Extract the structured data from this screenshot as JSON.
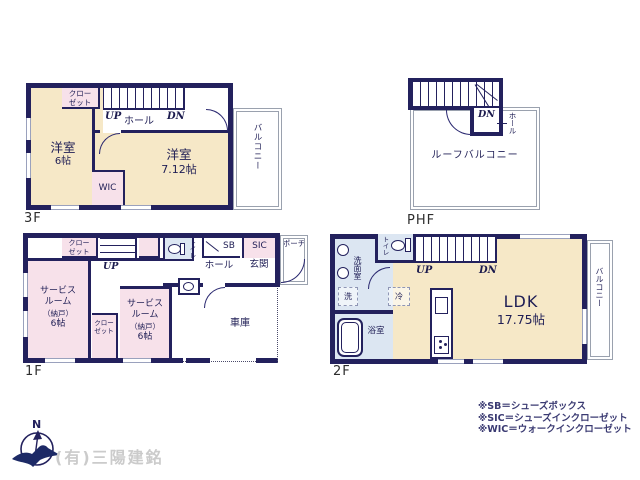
{
  "colors": {
    "wall_navy": "#23215d",
    "room_cream": "#f6e8c7",
    "room_pink": "#f7e1ea",
    "room_blue": "#dce6f2",
    "window_gray": "#9aa1bd",
    "legend_navy": "#3a3a72",
    "watermark_gray": "#cbcbcb"
  },
  "floor3": {
    "label": "3F",
    "closet_line1": "クロー",
    "closet_line2": "ゼット",
    "up": "UP",
    "dn": "DN",
    "hall": "ホール",
    "room1_name": "洋室",
    "room1_size": "6帖",
    "room2_name": "洋室",
    "room2_size": "7.12帖",
    "wic": "WIC",
    "balcony": "バルコニー"
  },
  "phf": {
    "label": "PHF",
    "dn": "DN",
    "hall": "ホール",
    "roof_balcony": "ルーフバルコニー"
  },
  "floor1": {
    "label": "1F",
    "closet1_line1": "クロー",
    "closet1_line2": "ゼット",
    "up": "UP",
    "toilet": "トイレ",
    "sb": "SB",
    "sic": "SIC",
    "porch": "ポーチ",
    "hall": "ホール",
    "entrance": "玄関",
    "service1_line1": "サービス",
    "service1_line2": "ルーム",
    "service1_line3": "（納戸）",
    "service1_line4": "6帖",
    "closet2_line1": "クロー",
    "closet2_line2": "ゼット",
    "service2_line1": "サービス",
    "service2_line2": "ルーム",
    "service2_line3": "（納戸）",
    "service2_line4": "6帖",
    "garage": "車庫"
  },
  "floor2": {
    "label": "2F",
    "toilet": "トイレ",
    "washroom": "洗面室",
    "laundry": "洗",
    "bath": "浴室",
    "fridge": "冷",
    "up": "UP",
    "dn": "DN",
    "ldk_name": "LDK",
    "ldk_size": "17.75帖",
    "balcony": "バルコニー"
  },
  "legend": {
    "line1": "※SB＝シューズボックス",
    "line2": "※SIC＝シューズインクローゼット",
    "line3": "※WIC＝ウォークインクローゼット"
  },
  "compass": {
    "north": "N"
  },
  "watermark": "(有)三陽建銘"
}
